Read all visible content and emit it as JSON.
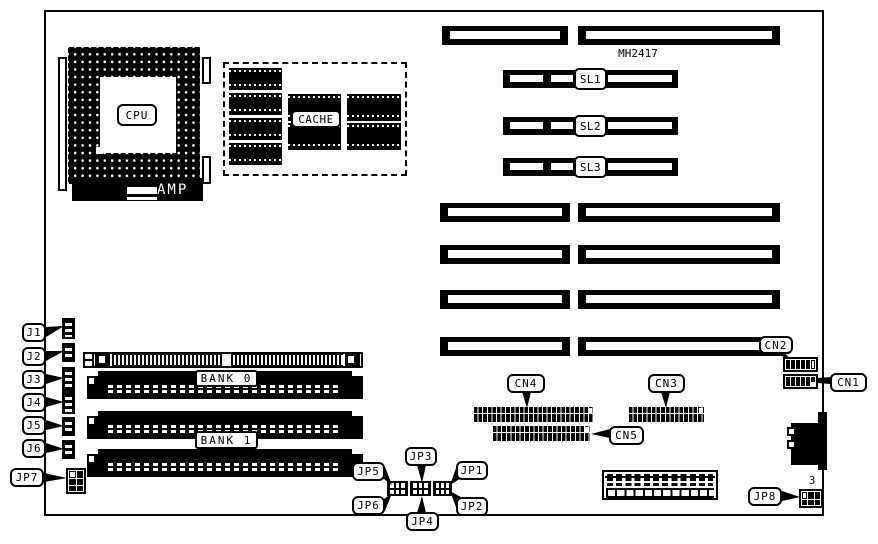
{
  "board": {
    "part_number": "MH2417"
  },
  "colors": {
    "ink": "#000000",
    "paper": "#ffffff"
  },
  "cpu": {
    "label": "CPU",
    "amp": "AMP"
  },
  "cache": {
    "label": "CACHE"
  },
  "memory": {
    "bank0": "BANK 0",
    "bank1": "BANK 1"
  },
  "sl_slots": {
    "sl1": "SL1",
    "sl2": "SL2",
    "sl3": "SL3"
  },
  "connectors": {
    "cn1": "CN1",
    "cn2": "CN2",
    "cn3": "CN3",
    "cn4": "CN4",
    "cn5": "CN5"
  },
  "headers": {
    "j1": "J1",
    "j2": "J2",
    "j3": "J3",
    "j4": "J4",
    "j5": "J5",
    "j6": "J6"
  },
  "jumpers": {
    "jp1": "JP1",
    "jp2": "JP2",
    "jp3": "JP3",
    "jp4": "JP4",
    "jp5": "JP5",
    "jp6": "JP6",
    "jp7": "JP7",
    "jp8": "JP8",
    "jp8_pin": "3"
  }
}
